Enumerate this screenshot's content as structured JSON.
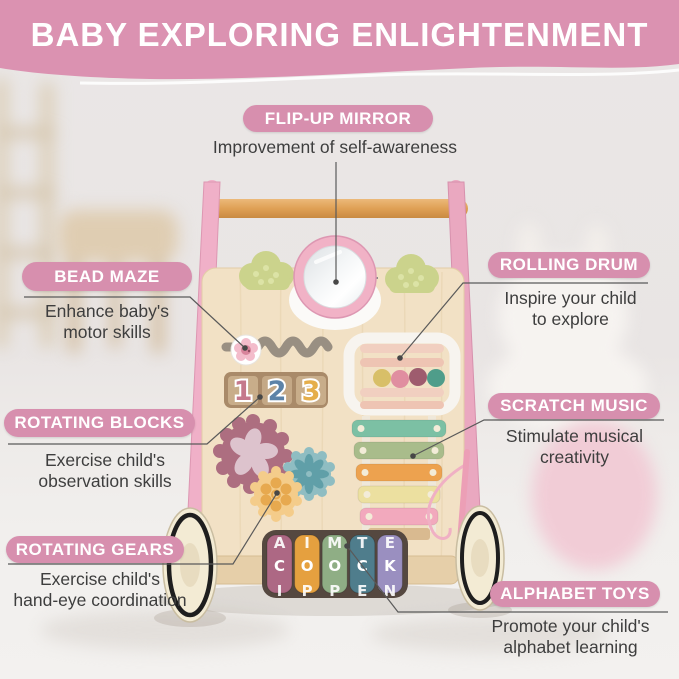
{
  "banner": {
    "title": "BABY EXPLORING ENLIGHTENMENT",
    "bg_color": "#db92b1",
    "pill_color": "#d78fae",
    "text_color": "#ffffff"
  },
  "callouts": [
    {
      "id": "flip-up-mirror",
      "label": "FLIP-UP MIRROR",
      "description": "Improvement of self-awareness"
    },
    {
      "id": "bead-maze",
      "label": "BEAD MAZE",
      "description": "Enhance baby's\nmotor skills"
    },
    {
      "id": "rolling-drum",
      "label": "ROLLING DRUM",
      "description": "Inspire your child\nto explore"
    },
    {
      "id": "rotating-blocks",
      "label": "ROTATING BLOCKS",
      "description": "Exercise child's\nobservation skills"
    },
    {
      "id": "scratch-music",
      "label": "SCRATCH MUSIC",
      "description": "Stimulate musical\ncreativity"
    },
    {
      "id": "rotating-gears",
      "label": "ROTATING GEARS",
      "description": "Exercise child's\nhand-eye coordination"
    },
    {
      "id": "alphabet-toys",
      "label": "ALPHABET TOYS",
      "description": "Promote your child's\nalphabet learning"
    }
  ],
  "toy": {
    "number_blocks": [
      {
        "value": "1",
        "color": "#c5798c"
      },
      {
        "value": "2",
        "color": "#5d83a8"
      },
      {
        "value": "3",
        "color": "#e5ae4b"
      }
    ],
    "alphabet_rollers": [
      {
        "color": "#ad6884",
        "letters": [
          "A",
          "C",
          "J"
        ]
      },
      {
        "color": "#e5a03f",
        "letters": [
          "I",
          "O",
          "P"
        ]
      },
      {
        "color": "#8fae85",
        "letters": [
          "M",
          "O",
          "P"
        ]
      },
      {
        "color": "#4f7d8c",
        "letters": [
          "T",
          "C",
          "E"
        ]
      },
      {
        "color": "#9a8fc0",
        "letters": [
          "E",
          "K",
          "N"
        ]
      }
    ],
    "xylophone_bars": [
      {
        "color": "#7cc0a4"
      },
      {
        "color": "#a9bc8b"
      },
      {
        "color": "#eda24f"
      },
      {
        "color": "#ece0a0"
      },
      {
        "color": "#f2a9bd"
      }
    ],
    "drum_beads": [
      {
        "color": "#d8bf68"
      },
      {
        "color": "#e08ea0"
      },
      {
        "color": "#9e5c6e"
      },
      {
        "color": "#4f9d8a"
      }
    ]
  }
}
